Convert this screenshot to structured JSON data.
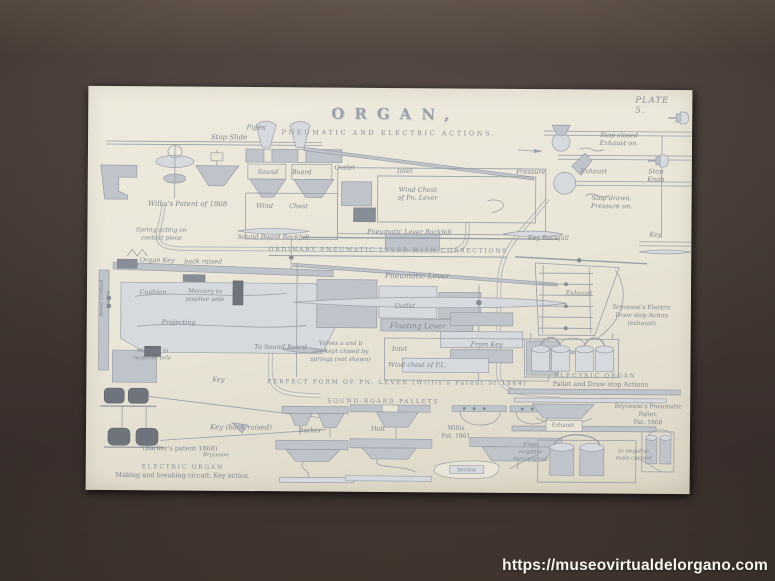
{
  "photo": {
    "watermark": "https://museovirtualdelorgano.com"
  },
  "plate": {
    "plate_no": "PLATE 5.",
    "title": "ORGAN,",
    "subtitle": "PNEUMATIC AND ELECTRIC ACTIONS.",
    "labels": [
      {
        "id": "pipes",
        "text": "Pipes",
        "x": 168,
        "y": 41,
        "fs": 7,
        "style": "script"
      },
      {
        "id": "stop-slide",
        "text": "Stop Slide",
        "x": 141,
        "y": 51,
        "fs": 7,
        "style": "script"
      },
      {
        "id": "sound",
        "text": "Sound",
        "x": 180,
        "y": 85,
        "fs": 6.5,
        "style": "script"
      },
      {
        "id": "board",
        "text": "Board",
        "x": 214,
        "y": 85,
        "fs": 6.5,
        "style": "script"
      },
      {
        "id": "wind",
        "text": "Wind",
        "x": 177,
        "y": 119,
        "fs": 6.5,
        "style": "script"
      },
      {
        "id": "chest",
        "text": "Chest",
        "x": 211,
        "y": 119,
        "fs": 6.5,
        "style": "script"
      },
      {
        "id": "willis-patent-1868",
        "text": "Willis's Patent of 1868",
        "x": 100,
        "y": 118,
        "fs": 7,
        "style": "script"
      },
      {
        "id": "sound-board-backfall",
        "text": "Sound Board Backfall",
        "x": 186,
        "y": 150,
        "fs": 6.5,
        "style": "script"
      },
      {
        "id": "outlet-top",
        "text": "Outlet",
        "x": 257,
        "y": 80,
        "fs": 6.5,
        "style": "script"
      },
      {
        "id": "inlet-top",
        "text": "Inlet",
        "x": 317,
        "y": 83,
        "fs": 6.5,
        "style": "script"
      },
      {
        "id": "wind-chest-pn-lever",
        "text": "Wind Chest\nof Pn. Lever",
        "x": 330,
        "y": 106,
        "fs": 6.5,
        "style": "script"
      },
      {
        "id": "pneumatic-lever-backfall",
        "text": "Pneumatic Lever Backfall",
        "x": 322,
        "y": 144,
        "fs": 6.5,
        "style": "script"
      },
      {
        "id": "key-backfall",
        "text": "Key Backfall",
        "x": 461,
        "y": 149,
        "fs": 6.5,
        "style": "script"
      },
      {
        "id": "ordinary-caption",
        "text": "ORDINARY PNEUMATIC LEVER WITH CORRECTIONS",
        "x": 301,
        "y": 164,
        "fs": 6,
        "style": "caps"
      },
      {
        "id": "pneumatic-lever",
        "text": "Pneumatic Lever",
        "x": 330,
        "y": 188,
        "fs": 7.5,
        "style": "script"
      },
      {
        "id": "outlet-mid",
        "text": "Outlet",
        "x": 318,
        "y": 218,
        "fs": 6.5,
        "style": "script"
      },
      {
        "id": "floating-lever",
        "text": "Floating Lever",
        "x": 331,
        "y": 238,
        "fs": 7.5,
        "style": "script"
      },
      {
        "id": "valves-note",
        "text": "Valves a and b\nare kept closed by\nsprings (not shown)",
        "x": 254,
        "y": 264,
        "fs": 6,
        "style": "script"
      },
      {
        "id": "inlet-mid",
        "text": "Inlet",
        "x": 313,
        "y": 261,
        "fs": 6.5,
        "style": "script"
      },
      {
        "id": "wind-chest-pl",
        "text": "Wind chest of P.L.",
        "x": 331,
        "y": 277,
        "fs": 6.5,
        "style": "script"
      },
      {
        "id": "from-key",
        "text": "From Key",
        "x": 400,
        "y": 256,
        "fs": 6.5,
        "style": "script"
      },
      {
        "id": "to-sound-board",
        "text": "To Sound Board",
        "x": 194,
        "y": 260,
        "fs": 6.5,
        "style": "script"
      },
      {
        "id": "perfect-caption",
        "text": "PERFECT FORM OF PN. LEVER (Willis's Patent of 1884)",
        "x": 311,
        "y": 295,
        "fs": 6,
        "style": "caps"
      },
      {
        "id": "spring-note",
        "text": "Spring acting on\ncontact piece",
        "x": 74,
        "y": 148,
        "fs": 6,
        "style": "script"
      },
      {
        "id": "organ-key",
        "text": "Organ Key",
        "x": 70,
        "y": 174,
        "fs": 6.5,
        "style": "script"
      },
      {
        "id": "back-raised",
        "text": "back raised",
        "x": 116,
        "y": 175,
        "fs": 6.5,
        "style": "script"
      },
      {
        "id": "cushion",
        "text": "Cushion",
        "x": 66,
        "y": 206,
        "fs": 6.5,
        "style": "script"
      },
      {
        "id": "mercury-positive",
        "text": "Mercury to\npositive pole",
        "x": 118,
        "y": 209,
        "fs": 6,
        "style": "script"
      },
      {
        "id": "projecting",
        "text": "Projecting",
        "x": 92,
        "y": 236,
        "fs": 6.5,
        "style": "script"
      },
      {
        "id": "wood-contact",
        "text": "wood contact\npiece",
        "x": 19,
        "y": 212,
        "fs": 5.5,
        "style": "vert"
      },
      {
        "id": "mercury-negative",
        "text": "Mercury to\nnegative pole",
        "x": 66,
        "y": 269,
        "fs": 5.5,
        "style": "script"
      },
      {
        "id": "key-left-small",
        "text": "Key",
        "x": 132,
        "y": 293,
        "fs": 6.5,
        "style": "script"
      },
      {
        "id": "key-back-raised",
        "text": "Key (back raised)",
        "x": 155,
        "y": 341,
        "fs": 7,
        "style": "script"
      },
      {
        "id": "barkers-patent",
        "text": "(Barker's patent 1868)",
        "x": 94,
        "y": 362,
        "fs": 6.5,
        "style": "plain"
      },
      {
        "id": "bryceson-sig",
        "text": "Bryceson",
        "x": 130,
        "y": 369,
        "fs": 5.5,
        "style": "script"
      },
      {
        "id": "electric-organ-left",
        "text": "ELECTRIC ORGAN",
        "x": 97,
        "y": 381,
        "fs": 6,
        "style": "caps"
      },
      {
        "id": "making-breaking",
        "text": "Making and breaking circuit. Key action.",
        "x": 97,
        "y": 389,
        "fs": 6.5,
        "style": "plain"
      },
      {
        "id": "sound-board-pallets",
        "text": "SOUND-BOARD PALLETS",
        "x": 297,
        "y": 314,
        "fs": 6,
        "style": "caps"
      },
      {
        "id": "barker-label",
        "text": "Barker",
        "x": 224,
        "y": 343,
        "fs": 6.5,
        "style": "plain"
      },
      {
        "id": "holt-label",
        "text": "Holt",
        "x": 292,
        "y": 341,
        "fs": 6.5,
        "style": "plain"
      },
      {
        "id": "willis-1861",
        "text": "Willis\nPat. 1861",
        "x": 370,
        "y": 344,
        "fs": 6,
        "style": "plain"
      },
      {
        "id": "section-label",
        "text": "Section",
        "x": 381,
        "y": 382,
        "fs": 5,
        "style": "plain"
      },
      {
        "id": "stop-closed",
        "text": "Stop closed\nExhaust on.",
        "x": 531,
        "y": 50,
        "fs": 6.5,
        "style": "script"
      },
      {
        "id": "pressure",
        "text": "Pressure",
        "x": 443,
        "y": 83,
        "fs": 6.5,
        "style": "script"
      },
      {
        "id": "exhaust-top",
        "text": "Exhaust",
        "x": 506,
        "y": 82,
        "fs": 6.5,
        "style": "script"
      },
      {
        "id": "stop-knob",
        "text": "Stop\nKnob",
        "x": 568,
        "y": 86,
        "fs": 6.5,
        "style": "script"
      },
      {
        "id": "stop-drawn",
        "text": "Stop drawn.\nPressure on.",
        "x": 524,
        "y": 113,
        "fs": 6.5,
        "style": "script"
      },
      {
        "id": "key-right",
        "text": "Key",
        "x": 568,
        "y": 145,
        "fs": 6.5,
        "style": "script"
      },
      {
        "id": "exhaust-mid",
        "text": "Exhaust",
        "x": 492,
        "y": 204,
        "fs": 6.5,
        "style": "script"
      },
      {
        "id": "brycesons-electric",
        "text": "Bryceson's Electric\nDraw stop Action\n(exhaust)",
        "x": 555,
        "y": 226,
        "fs": 6,
        "style": "plain"
      },
      {
        "id": "electric-organ-right",
        "text": "ELECTRIC ORGAN",
        "x": 509,
        "y": 287,
        "fs": 6,
        "style": "caps"
      },
      {
        "id": "pallet-drawstop",
        "text": "Pallet and Draw stop Actions",
        "x": 514,
        "y": 295,
        "fs": 6.5,
        "style": "plain"
      },
      {
        "id": "brycesons-pneumatic",
        "text": "Bryceson's Pneumatic\nPallet.\nPat. 1868",
        "x": 562,
        "y": 325,
        "fs": 6,
        "style": "plain"
      },
      {
        "id": "exhaust-box",
        "text": "Exhaust",
        "x": 477,
        "y": 337,
        "fs": 5.5,
        "style": "plain"
      },
      {
        "id": "from-negative",
        "text": "From\nnegative\nmercury cup",
        "x": 445,
        "y": 364,
        "fs": 5.5,
        "style": "script"
      },
      {
        "id": "to-negative",
        "text": "to negative\nmain current",
        "x": 548,
        "y": 366,
        "fs": 5.5,
        "style": "script"
      }
    ]
  }
}
